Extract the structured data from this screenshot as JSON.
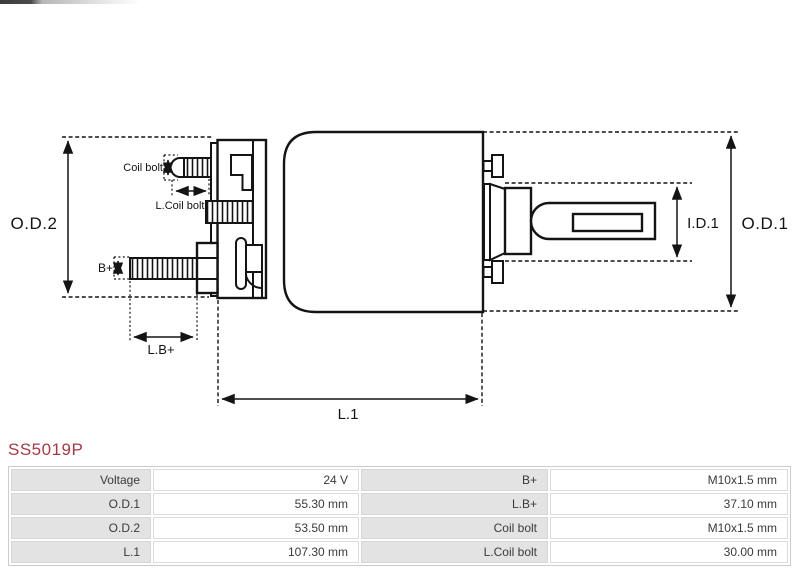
{
  "part_number": "SS5019P",
  "colors": {
    "accent": "#a63a44",
    "line": "#141414",
    "table_label_bg": "#e3e3e3"
  },
  "diagram": {
    "labels": {
      "od2": "O.D.2",
      "od1": "O.D.1",
      "id1": "I.D.1",
      "l1": "L.1",
      "coil_bolt": "Coil bolt",
      "l_coil_bolt": "L.Coil bolt",
      "b_plus": "B+",
      "l_b_plus": "L.B+"
    }
  },
  "spec_table": {
    "rows": [
      {
        "label1": "Voltage",
        "value1": "24 V",
        "label2": "B+",
        "value2": "M10x1.5 mm"
      },
      {
        "label1": "O.D.1",
        "value1": "55.30 mm",
        "label2": "L.B+",
        "value2": "37.10 mm"
      },
      {
        "label1": "O.D.2",
        "value1": "53.50 mm",
        "label2": "Coil bolt",
        "value2": "M10x1.5 mm"
      },
      {
        "label1": "L.1",
        "value1": "107.30 mm",
        "label2": "L.Coil bolt",
        "value2": "30.00 mm"
      }
    ]
  }
}
